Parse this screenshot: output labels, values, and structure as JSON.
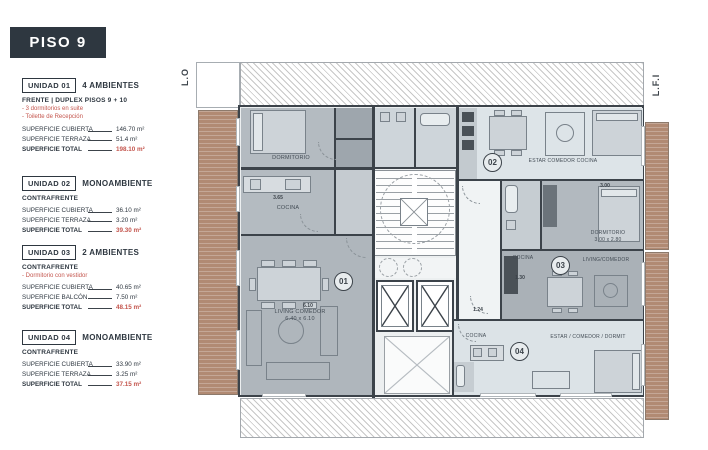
{
  "colors": {
    "dark_navy": "#2e3740",
    "accent_red": "#c4564e",
    "wall": "#3c434a",
    "deck_wood": "#b18a73",
    "unit_fill_medium": "#b4bbc1",
    "unit_fill_light": "#dde4e8"
  },
  "sidebar": {
    "title": "PISO 9",
    "units": [
      {
        "tag": "UNIDAD 01",
        "type": "4 AMBIENTES",
        "subtitle": "FRENTE | DUPLEX PISOS 9 + 10",
        "features": [
          "- 3 dormitorios en suite",
          "- Toilette de Recepción"
        ],
        "rows": [
          {
            "label": "SUPERFICIE CUBIERTA",
            "value": "146.70 m²"
          },
          {
            "label": "SUPERFICIE TERRAZA",
            "value": "51.4 m²"
          }
        ],
        "total": {
          "label": "SUPERFICIE TOTAL",
          "value": "198.10 m²"
        }
      },
      {
        "tag": "UNIDAD 02",
        "type": "MONOAMBIENTE",
        "subtitle": "CONTRAFRENTE",
        "features": [],
        "rows": [
          {
            "label": "SUPERFICIE CUBIERTA",
            "value": "36.10 m²"
          },
          {
            "label": "SUPERFICIE TERRAZA",
            "value": "3.20 m²"
          }
        ],
        "total": {
          "label": "SUPERFICIE TOTAL",
          "value": "39.30 m²"
        }
      },
      {
        "tag": "UNIDAD 03",
        "type": "2 AMBIENTES",
        "subtitle": "CONTRAFRENTE",
        "features": [
          "- Dormitorio con vestidor"
        ],
        "rows": [
          {
            "label": "SUPERFICIE CUBIERTA",
            "value": "40.65 m²"
          },
          {
            "label": "SUPERFICIE BALCÓN",
            "value": "7.50 m²"
          }
        ],
        "total": {
          "label": "SUPERFICIE TOTAL",
          "value": "48.15 m²"
        }
      },
      {
        "tag": "UNIDAD 04",
        "type": "MONOAMBIENTE",
        "subtitle": "CONTRAFRENTE",
        "features": [],
        "rows": [
          {
            "label": "SUPERFICIE CUBIERTA",
            "value": "33.90 m²"
          },
          {
            "label": "SUPERFICIE TERRAZA",
            "value": "3.25 m²"
          }
        ],
        "total": {
          "label": "SUPERFICIE TOTAL",
          "value": "37.15 m²"
        }
      }
    ]
  },
  "plan": {
    "left_edge_label": "L.O",
    "right_edge_label": "L.F.I",
    "unit_circles": {
      "u1": "01",
      "u2": "02",
      "u3": "03",
      "u4": "04"
    },
    "rooms": {
      "u1_bedroom": "DORMITORIO",
      "u1_kitchen": "COCINA",
      "u1_living": "LIVING COMEDOR",
      "u1_living_dim": "6.40 x 6.10",
      "u2_main": "ESTAR COMEDOR COCINA",
      "u3_bedroom": "DORMITORIO",
      "u3_bedroom_dim": "3.00 x 2.80",
      "u3_kitchen": "COCINA",
      "u3_living": "LIVING/COMEDOR",
      "u4_kitchen": "COCINA",
      "u4_main": "ESTAR / COMEDOR / DORMIT"
    },
    "dims": {
      "d610": "6.10",
      "d365": "3.65",
      "d124": "1.24",
      "d130": "1.30",
      "d300": "3.00"
    }
  }
}
